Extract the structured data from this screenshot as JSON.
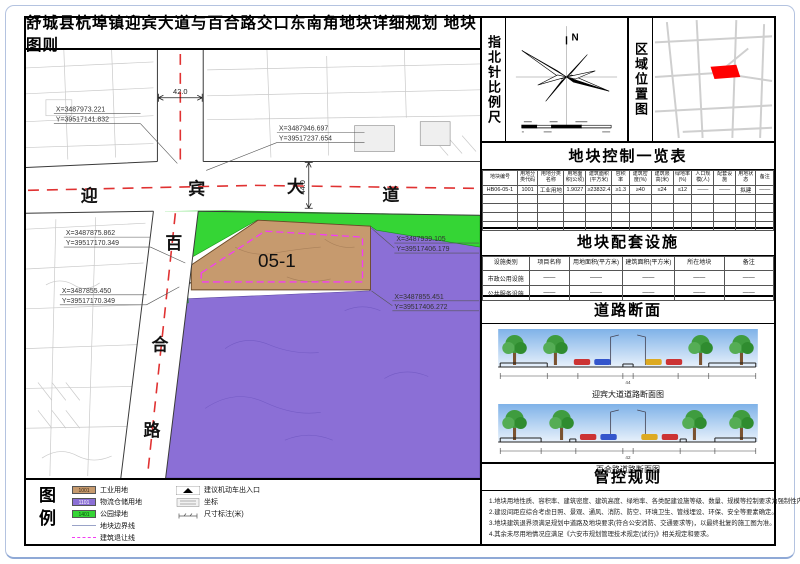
{
  "title": "舒城县杭埠镇迎宾大道与百合路交口东南角地块详细规划  地块图则",
  "compass": {
    "label": "指北针比例尺",
    "north": "N"
  },
  "location": {
    "label": "区域位置图"
  },
  "control_table": {
    "title": "地块控制一览表",
    "headers": [
      "地块编号",
      "用地分类代码",
      "用地分类名称",
      "用地面积(公顷)",
      "建筑面积(平方米)",
      "容积率",
      "建筑密度(%)",
      "建筑限高(米)",
      "绿地率(%)",
      "人口规模(人)",
      "配套设施",
      "用地状态",
      "备注"
    ],
    "row": [
      "HB06-05-1",
      "1001",
      "工业用地",
      "1.9027",
      "≥23832.4",
      "≥1.3",
      "≥40",
      "≤24",
      "≤12",
      "——",
      "——",
      "拟建",
      "——"
    ]
  },
  "facilities": {
    "title": "地块配套设施",
    "headers": [
      "设施类别",
      "项目名称",
      "用地面积(平方米)",
      "建筑面积(平方米)",
      "所在地块",
      "备注"
    ],
    "rows": [
      [
        "市政公用设施",
        "——",
        "——",
        "——",
        "——",
        "——"
      ],
      [
        "公共服务设施",
        "——",
        "——",
        "——",
        "——",
        "——"
      ]
    ]
  },
  "sections": {
    "title": "道路断面",
    "captions": [
      "迎宾大道道路断面图",
      "百合路道路断面图"
    ],
    "totals": [
      "44",
      "42"
    ]
  },
  "rules": {
    "title": "管控规则",
    "lines": [
      "1.地块用地性质、容积率、建筑密度、建筑高度、绿地率、各类配建设施等级、数量、规模等控制要求为强制性内容。",
      "2.建设间距应综合考虑日照、景观、通风、消防、防空、环境卫生、管线埋设、环保、安全等要素确定。",
      "3.地块建筑退界须满足规划中道路及地块要求(符合公安消防、交通要求等)，以最终批复的施工图为准。",
      "4.其余未尽用地情况应满足《六安市规划管理技术规定(试行)》相关规定和要求。"
    ]
  },
  "legend": {
    "label": "图例",
    "items": [
      {
        "code": "1001",
        "label": "工业用地",
        "color": "#c69a6e"
      },
      {
        "code": "1101",
        "label": "物流仓储用地",
        "color": "#8b6fd6"
      },
      {
        "code": "1401",
        "label": "公园绿地",
        "color": "#35d535"
      },
      {
        "code": "",
        "label": "地块边界线",
        "color": "#9aa3c8"
      },
      {
        "code": "",
        "label": "建筑退让线",
        "color": "#f43cf4"
      }
    ],
    "markers": [
      {
        "label": "建议机动车出入口"
      },
      {
        "label": "坐标"
      },
      {
        "label": "尺寸标注(米)"
      }
    ]
  },
  "map": {
    "avenue_chars": [
      "迎",
      "宾",
      "大",
      "道"
    ],
    "road_chars": [
      "百",
      "合",
      "路"
    ],
    "plot_label": "05-1",
    "dim_top": "42.0",
    "dim_right": "44.0",
    "coords": [
      {
        "x": "X=3487973.221",
        "y": "Y=39517141.832"
      },
      {
        "x": "X=3487946.697",
        "y": "Y=39517237.654"
      },
      {
        "x": "X=3487875.862",
        "y": "Y=39517170.349"
      },
      {
        "x": "X=3487855.450",
        "y": "Y=39517170.349"
      },
      {
        "x": "X=3487939.105",
        "y": "Y=39517406.179"
      },
      {
        "x": "X=3487855.451",
        "y": "Y=39517406.272"
      }
    ]
  },
  "colors": {
    "industrial": "#c69a6e",
    "logistics": "#8b6fd6",
    "park_green": "#35d535",
    "setback_magenta": "#f43cf4",
    "road_centerline_red": "#e03232",
    "minimap_plot_red": "#ff0000"
  }
}
